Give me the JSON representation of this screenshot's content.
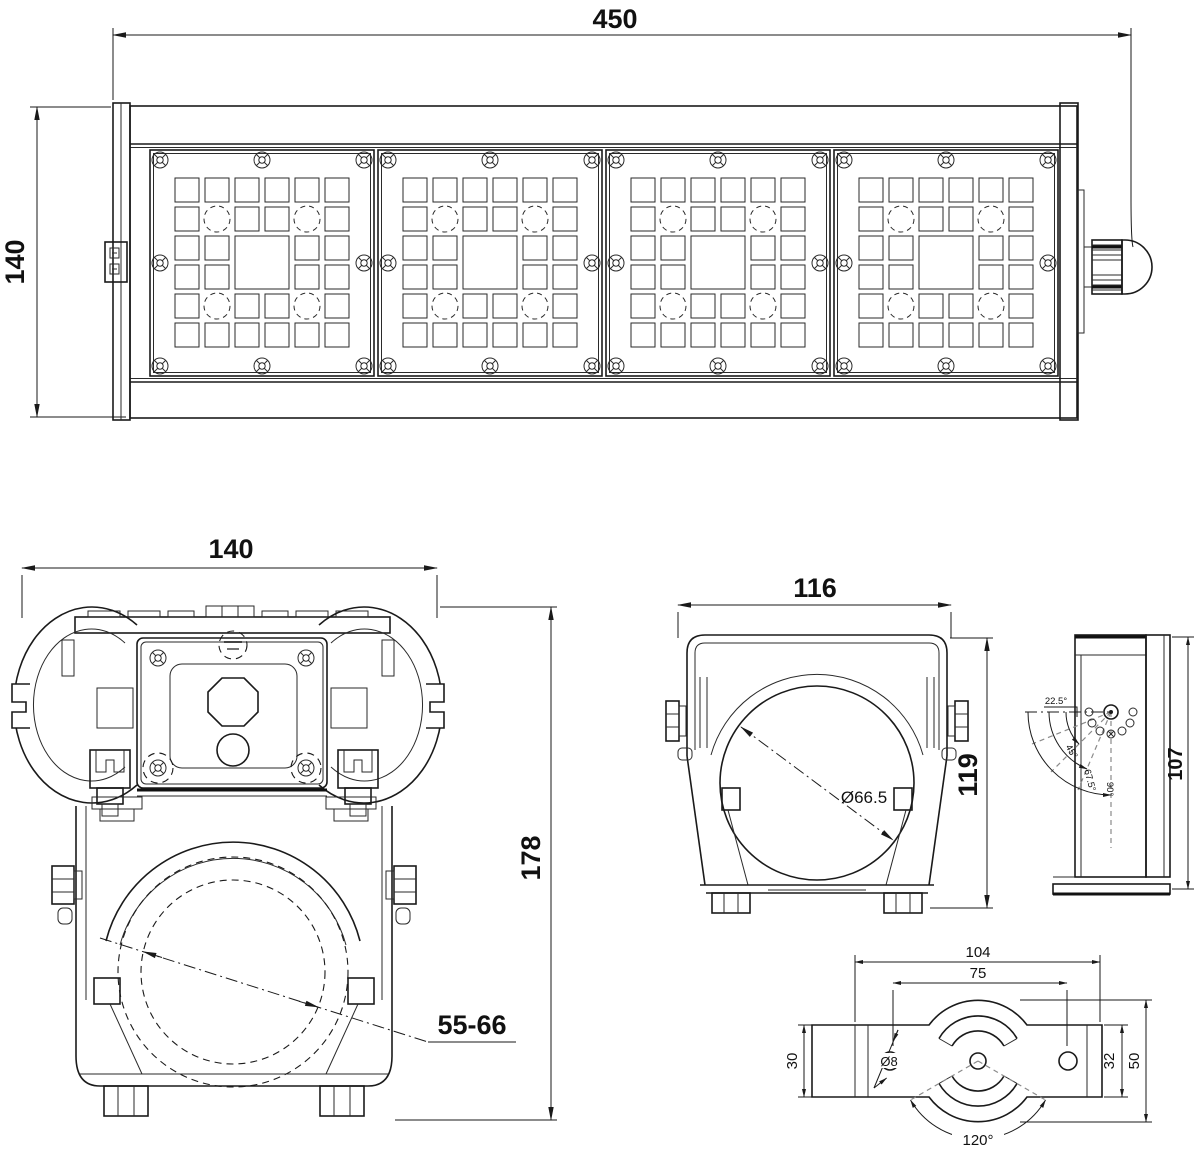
{
  "drawing": {
    "front_view": {
      "width_dim": "450",
      "height_dim": "140"
    },
    "end_view": {
      "width_dim": "140",
      "height_dim": "178",
      "pole_range_dim": "55-66"
    },
    "bracket_front_view": {
      "width_dim": "116",
      "height_dim": "119",
      "bore_dim": "Ø66.5"
    },
    "bracket_side_view": {
      "height_dim": "107",
      "angles": {
        "a22": "22.5°",
        "a45": "45°",
        "a67": "67.5°",
        "a90": "90°"
      }
    },
    "mount_plate_view": {
      "overall_width_dim": "104",
      "hole_spacing_dim": "75",
      "left_height_dim": "30",
      "inner_height_dim": "32",
      "overall_height_dim": "50",
      "slot_angle_dim": "120°",
      "hole_dia_dim": "Ø8"
    }
  }
}
